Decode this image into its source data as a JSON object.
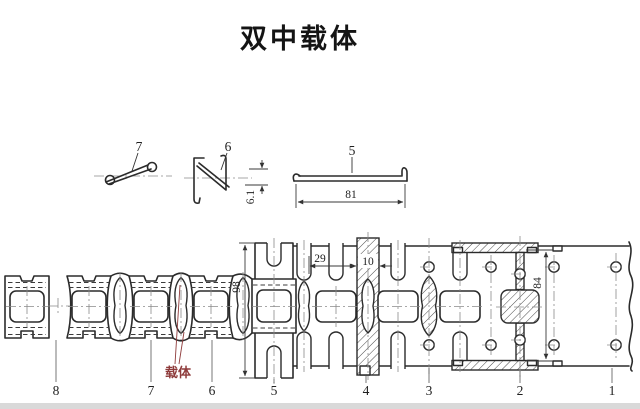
{
  "title": "双中载体",
  "colors": {
    "line": "#2b2b2b",
    "dimension": "#3a3a3a",
    "centerline": "#8a8a8a",
    "carrier_red": "#8e3b3b",
    "background": "#ffffff",
    "bottom_bar": "#d9d9d9"
  },
  "profiles": {
    "item7": {
      "label": "7"
    },
    "item6": {
      "label": "6",
      "height_dim": "6.1"
    },
    "item5": {
      "label": "5",
      "width_dim": "81"
    }
  },
  "strip": {
    "carrier_label": "载体",
    "dims": {
      "pitch": "29",
      "lance_width": "10",
      "part_height": "98",
      "strip_width": "84"
    },
    "stations": [
      {
        "label": "8"
      },
      {
        "label": "7"
      },
      {
        "label": "6"
      },
      {
        "label": "5"
      },
      {
        "label": "4"
      },
      {
        "label": "3"
      },
      {
        "label": "2"
      },
      {
        "label": "1"
      }
    ]
  }
}
